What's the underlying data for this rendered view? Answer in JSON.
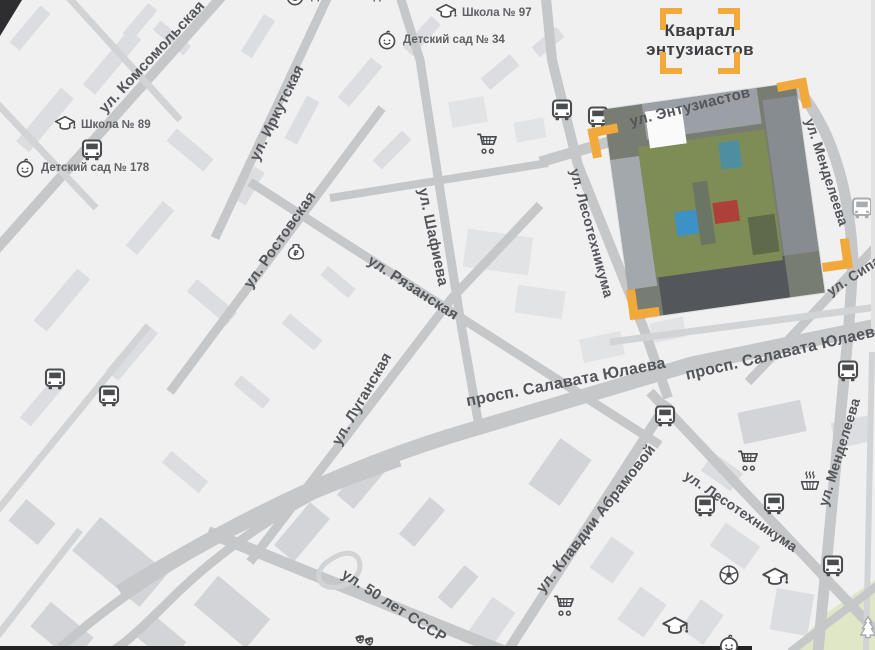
{
  "title": "Квартал энтузиастов — карта расположения",
  "logo": {
    "line1": "Квартал",
    "line2": "энтузиастов"
  },
  "colors": {
    "background": "#f0f0f1",
    "road": "#c6c7c9",
    "road_light": "#d2d3d5",
    "building": [
      "#dcdde0",
      "#e2e3e5",
      "#d3d4d7"
    ],
    "street_text": "#54555a",
    "poi_text": "#5f6063",
    "icon": "#4b4c4f",
    "icon_light": "#aaabad",
    "accent_yellow": "#f2a93b",
    "park_green": "#dfe7c6",
    "logo_text": "#3d3e40",
    "dark_edge": "#232324"
  },
  "street_labels": [
    {
      "text": "ул. Комсомольская",
      "x": 152,
      "y": 57,
      "rot": -47,
      "fs": 15
    },
    {
      "text": "ул. Иркутская",
      "x": 277,
      "y": 113,
      "rot": -64,
      "fs": 15
    },
    {
      "text": "ул. Ростовская",
      "x": 280,
      "y": 240,
      "rot": -55,
      "fs": 15
    },
    {
      "text": "ул. Рязанская",
      "x": 413,
      "y": 288,
      "rot": 33,
      "fs": 15
    },
    {
      "text": "ул. Шафиева",
      "x": 433,
      "y": 237,
      "rot": 78,
      "fs": 15
    },
    {
      "text": "ул. Луганская",
      "x": 362,
      "y": 399,
      "rot": -60,
      "fs": 15
    },
    {
      "text": "ул. Лесотехникума",
      "x": 592,
      "y": 233,
      "rot": 75,
      "fs": 14
    },
    {
      "text": "ул. Энтузиастов",
      "x": 690,
      "y": 107,
      "rot": -14,
      "fs": 15
    },
    {
      "text": "ул. Менделеева",
      "x": 827,
      "y": 172,
      "rot": 72,
      "fs": 14
    },
    {
      "text": "ул. Сипайловская",
      "x": 828,
      "y": 292,
      "rot": -33,
      "fs": 14,
      "anchor": "left"
    },
    {
      "text": "просп. Салавата Юлаева",
      "x": 566,
      "y": 383,
      "rot": -11,
      "fs": 16
    },
    {
      "text": "просп. Салавата Юлаева",
      "x": 686,
      "y": 376,
      "rot": -13,
      "fs": 16,
      "anchor": "left"
    },
    {
      "text": "ул. Клавдии Абрамовой",
      "x": 596,
      "y": 519,
      "rot": -52,
      "fs": 15
    },
    {
      "text": "ул. Лесотехникума",
      "x": 741,
      "y": 511,
      "rot": 34,
      "fs": 14
    },
    {
      "text": "ул. Менделеева",
      "x": 839,
      "y": 452,
      "rot": -73,
      "fs": 14
    },
    {
      "text": "ул. 50 лет СССР",
      "x": 394,
      "y": 606,
      "rot": 33,
      "fs": 15
    }
  ],
  "poi_labels": [
    {
      "icon": "school",
      "text": "Школа № 89",
      "x": 54,
      "y": 114
    },
    {
      "icon": "kindergarten",
      "text": "Детский сад № 178",
      "x": 14,
      "y": 157
    },
    {
      "icon": "school",
      "text": "Школа № 97",
      "x": 435,
      "y": 2
    },
    {
      "icon": "kindergarten",
      "text": "Детский сад № 34",
      "x": 376,
      "y": 29
    },
    {
      "icon": "kindergarten",
      "text": "Детский сад №",
      "x": 284,
      "y": -15
    }
  ],
  "icons": [
    {
      "type": "tram",
      "x": 92,
      "y": 150
    },
    {
      "type": "tram",
      "x": 55,
      "y": 379
    },
    {
      "type": "tram",
      "x": 109,
      "y": 396
    },
    {
      "type": "tram",
      "x": 562,
      "y": 110
    },
    {
      "type": "tram",
      "x": 598,
      "y": 117
    },
    {
      "type": "tram",
      "x": 665,
      "y": 416
    },
    {
      "type": "tram",
      "x": 848,
      "y": 371
    },
    {
      "type": "tram",
      "x": 705,
      "y": 506
    },
    {
      "type": "tram",
      "x": 774,
      "y": 504
    },
    {
      "type": "tram",
      "x": 833,
      "y": 566
    },
    {
      "type": "tram",
      "x": 862,
      "y": 208,
      "light": true
    },
    {
      "type": "cart",
      "x": 487,
      "y": 143
    },
    {
      "type": "cart",
      "x": 748,
      "y": 460
    },
    {
      "type": "cart",
      "x": 564,
      "y": 605
    },
    {
      "type": "school",
      "x": 775,
      "y": 579,
      "s": 1.15
    },
    {
      "type": "school",
      "x": 675,
      "y": 628,
      "s": 1.15
    },
    {
      "type": "kindergarten",
      "x": 729,
      "y": 645
    },
    {
      "type": "soccer",
      "x": 729,
      "y": 575
    },
    {
      "type": "masks",
      "x": 366,
      "y": 644
    },
    {
      "type": "moneybag",
      "x": 296,
      "y": 252
    },
    {
      "type": "basket",
      "x": 810,
      "y": 480
    },
    {
      "type": "tree",
      "x": 868,
      "y": 627,
      "light": true
    }
  ],
  "map": {
    "roads": [
      {
        "d": "M-15,262 L232,-15",
        "w": 10
      },
      {
        "d": "M60,-12 L180,120",
        "w": 7
      },
      {
        "d": "M-10,96 L96,208",
        "w": 7
      },
      {
        "d": "M215,238 L332,-12",
        "w": 9
      },
      {
        "d": "M170,392 L382,108",
        "w": 9
      },
      {
        "d": "M250,562 L452,298 L540,205",
        "w": 9
      },
      {
        "d": "M-12,522 L148,326",
        "w": 7
      },
      {
        "d": "M-12,648 L80,530",
        "w": 7
      },
      {
        "d": "M250,182 L480,330 L660,445",
        "w": 9
      },
      {
        "d": "M398,-10 L420,60 L440,190 L462,330 L480,432",
        "w": 9
      },
      {
        "d": "M330,198 L548,163",
        "w": 8
      },
      {
        "d": "M545,-12 L552,60 L578,165 L645,332 L668,398",
        "w": 10
      },
      {
        "d": "M540,162 L800,86",
        "w": 11
      },
      {
        "d": "M797,88 C836,134 850,200 853,262 L848,338",
        "w": 11
      },
      {
        "d": "M848,336 L818,652",
        "w": 11
      },
      {
        "d": "M884,238 L790,338 L748,382",
        "w": 9
      },
      {
        "d": "M120,592 C250,512 360,462 470,430 L692,364 L886,324",
        "w": 15
      },
      {
        "d": "M610,342 L885,306",
        "w": 7
      },
      {
        "d": "M60,648 C160,560 260,512 400,462",
        "w": 9
      },
      {
        "d": "M470,430 C340,470 240,530 170,600 C140,630 120,648 110,652",
        "w": 9
      },
      {
        "d": "M208,532 L530,662",
        "w": 12
      },
      {
        "d": "M330,560 C362,538 372,576 342,586 C318,593 310,572 330,560",
        "w": 5
      },
      {
        "d": "M505,655 L668,402",
        "w": 10
      },
      {
        "d": "M650,392 L884,640",
        "w": 10
      },
      {
        "d": "M872,352 L866,650",
        "w": 6
      },
      {
        "d": "M790,652 L882,582",
        "w": 8
      }
    ],
    "buildings": [
      [
        45,
        120,
        70,
        17,
        -50
      ],
      [
        112,
        62,
        72,
        16,
        -50
      ],
      [
        30,
        28,
        48,
        13,
        -50
      ],
      [
        150,
        228,
        58,
        15,
        -50
      ],
      [
        190,
        150,
        16,
        48,
        -50
      ],
      [
        140,
        22,
        40,
        12,
        -50
      ],
      [
        172,
        38,
        12,
        40,
        -50
      ],
      [
        258,
        36,
        44,
        13,
        -58
      ],
      [
        302,
        120,
        48,
        14,
        -62
      ],
      [
        250,
        186,
        38,
        12,
        -60
      ],
      [
        360,
        82,
        52,
        15,
        -50
      ],
      [
        422,
        36,
        42,
        13,
        -48
      ],
      [
        392,
        150,
        42,
        13,
        -45
      ],
      [
        500,
        72,
        38,
        15,
        -40
      ],
      [
        548,
        42,
        32,
        13,
        -40
      ],
      [
        498,
        252,
        66,
        38,
        8,
        1
      ],
      [
        540,
        302,
        48,
        28,
        8,
        1
      ],
      [
        602,
        347,
        42,
        24,
        -12,
        1
      ],
      [
        668,
        330,
        34,
        20,
        -12,
        1
      ],
      [
        62,
        300,
        68,
        17,
        -50
      ],
      [
        132,
        352,
        62,
        16,
        -50
      ],
      [
        42,
        402,
        52,
        14,
        -50
      ],
      [
        212,
        302,
        16,
        52,
        -50
      ],
      [
        302,
        332,
        42,
        13,
        40
      ],
      [
        252,
        392,
        38,
        12,
        40
      ],
      [
        338,
        282,
        36,
        12,
        40
      ],
      [
        120,
        562,
        88,
        44,
        40,
        2
      ],
      [
        232,
        612,
        68,
        38,
        40,
        2
      ],
      [
        62,
        632,
        56,
        32,
        40,
        2
      ],
      [
        32,
        522,
        38,
        28,
        40,
        2
      ],
      [
        185,
        472,
        48,
        15,
        40
      ],
      [
        302,
        532,
        26,
        56,
        40,
        2
      ],
      [
        362,
        482,
        22,
        52,
        40,
        2
      ],
      [
        422,
        522,
        20,
        48,
        40,
        2
      ],
      [
        458,
        587,
        18,
        42,
        40,
        2
      ],
      [
        162,
        640,
        40,
        28,
        40,
        2
      ],
      [
        560,
        472,
        56,
        38,
        -55,
        2
      ],
      [
        612,
        560,
        38,
        28,
        -55
      ],
      [
        492,
        622,
        42,
        28,
        -55
      ],
      [
        642,
        612,
        32,
        40,
        35
      ],
      [
        735,
        546,
        42,
        28,
        35
      ],
      [
        792,
        612,
        38,
        42,
        10
      ],
      [
        702,
        622,
        28,
        36,
        35
      ],
      [
        772,
        422,
        64,
        32,
        -12,
        2
      ],
      [
        852,
        432,
        38,
        26,
        -12
      ],
      [
        722,
        472,
        36,
        22,
        35
      ],
      [
        468,
        112,
        36,
        26,
        -10,
        1
      ],
      [
        530,
        130,
        30,
        20,
        -10,
        1
      ]
    ],
    "park_polygon": "788,652 828,612 878,578 878,652",
    "dark_edges": {
      "bottom_strip": [
        0,
        646,
        752,
        5
      ],
      "corner_wedge": "0,0 22,0 0,36"
    },
    "photo": {
      "x": 617,
      "y": 95,
      "w": 194,
      "h": 212,
      "rot": -8
    },
    "brackets": [
      {
        "corner": "tl",
        "x": 590,
        "y": 126,
        "rot": -11
      },
      {
        "corner": "tr",
        "x": 779,
        "y": 80,
        "rot": -11
      },
      {
        "corner": "br",
        "x": 821,
        "y": 240,
        "rot": -8
      },
      {
        "corner": "bl",
        "x": 628,
        "y": 288,
        "rot": -8
      }
    ],
    "logo_box": {
      "x": 650,
      "y": 8,
      "w": 100,
      "h": 66
    }
  }
}
